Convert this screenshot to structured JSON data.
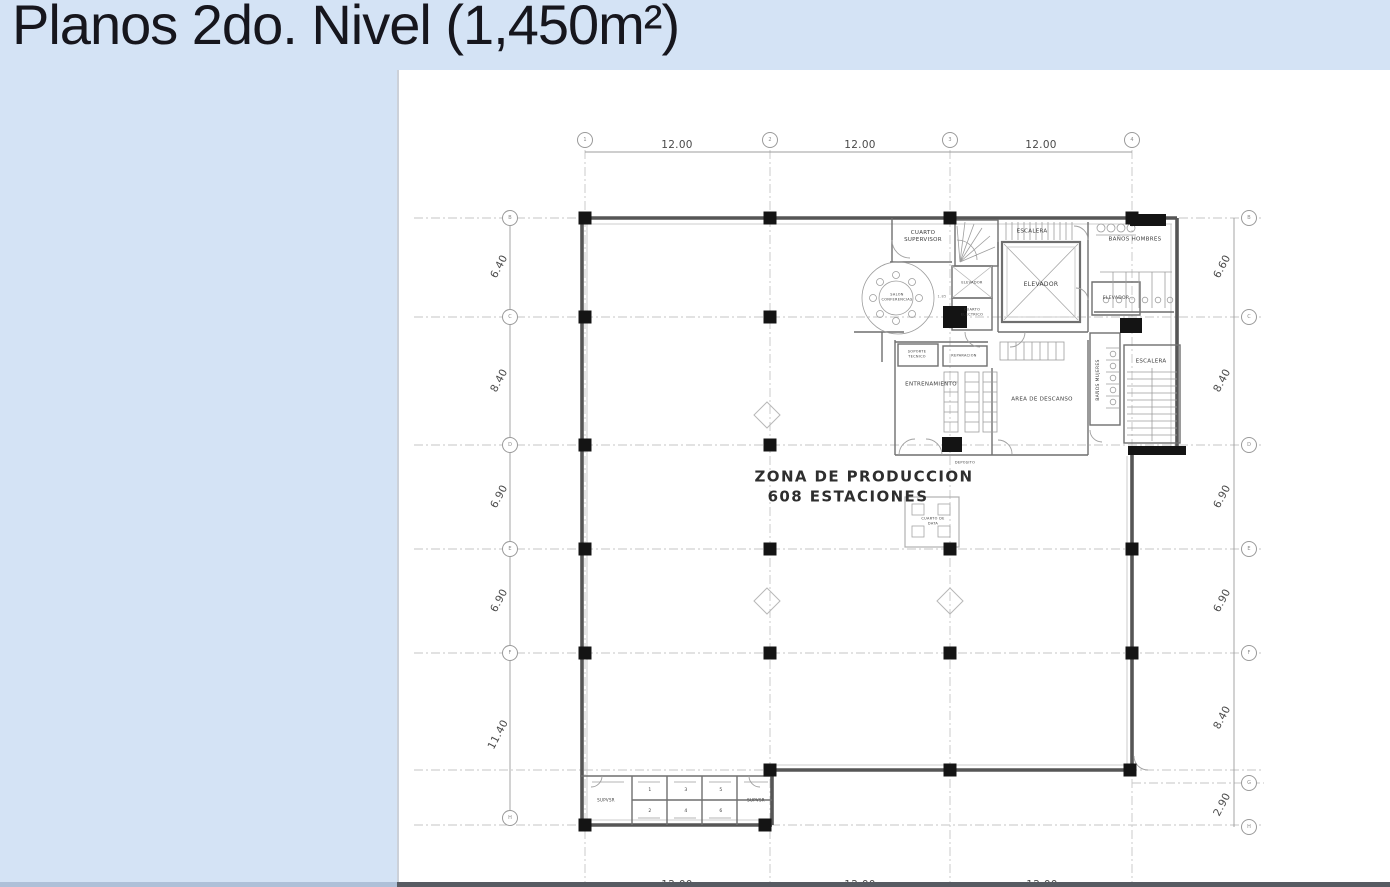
{
  "title": "Planos 2do. Nivel (1,450m²)",
  "colors": {
    "background": "#d4e3f5",
    "canvas": "#ffffff",
    "wall": "#555555",
    "bottom_bar": "#575b62"
  },
  "grid": {
    "top_bubbles": [
      "1",
      "2",
      "3",
      "4"
    ],
    "left_bubbles": [
      "B",
      "C",
      "D",
      "E",
      "F",
      "H"
    ],
    "right_bubbles": [
      "B",
      "C",
      "D",
      "E",
      "F",
      "G",
      "H"
    ],
    "dims_top": [
      "12.00",
      "12.00",
      "12.00"
    ],
    "dims_bottom": [
      "12.00",
      "12.00",
      "12.00"
    ],
    "dims_left": [
      "6.40",
      "8.40",
      "6.90",
      "6.90",
      "11.40"
    ],
    "dims_right": [
      "6.60",
      "8.40",
      "6.90",
      "6.90",
      "8.40",
      "2.90"
    ]
  },
  "zone": {
    "line1": "ZONA DE PRODUCCION",
    "line2": "608 ESTACIONES"
  },
  "rooms": {
    "cuarto_supervisor": "CUARTO\nSUPERVISOR",
    "salon_conferencias": "SALON\nCONFERENCIAS",
    "escalera_top": "ESCALERA",
    "elevador_main": "ELEVADOR",
    "elevador_small": "ELEVADOR",
    "cuarto_electrico": "CUARTO\nELECTRICO",
    "banos_hombres": "BAÑOS HOMBRES",
    "elevador_right": "ELEVADOR",
    "soporte_tecnico": "SOPORTE\nTECNICO",
    "reparacion": "REPARACION",
    "entrenamiento": "ENTRENAMIENTO",
    "area_descanso": "AREA DE DESCANSO",
    "banos_mujeres": "BAÑOS MUJERES",
    "escalera_right": "ESCALERA",
    "deposito": "DEPOSITO",
    "cuarto_data": "CUARTO DE\nDATA",
    "supvsr_left": "SUPVSR",
    "supvsr_right": "SUPVSR"
  },
  "cubicles": [
    "1",
    "2",
    "3",
    "4",
    "5",
    "6"
  ],
  "annotations": {
    "dim_conference": "1.85"
  }
}
